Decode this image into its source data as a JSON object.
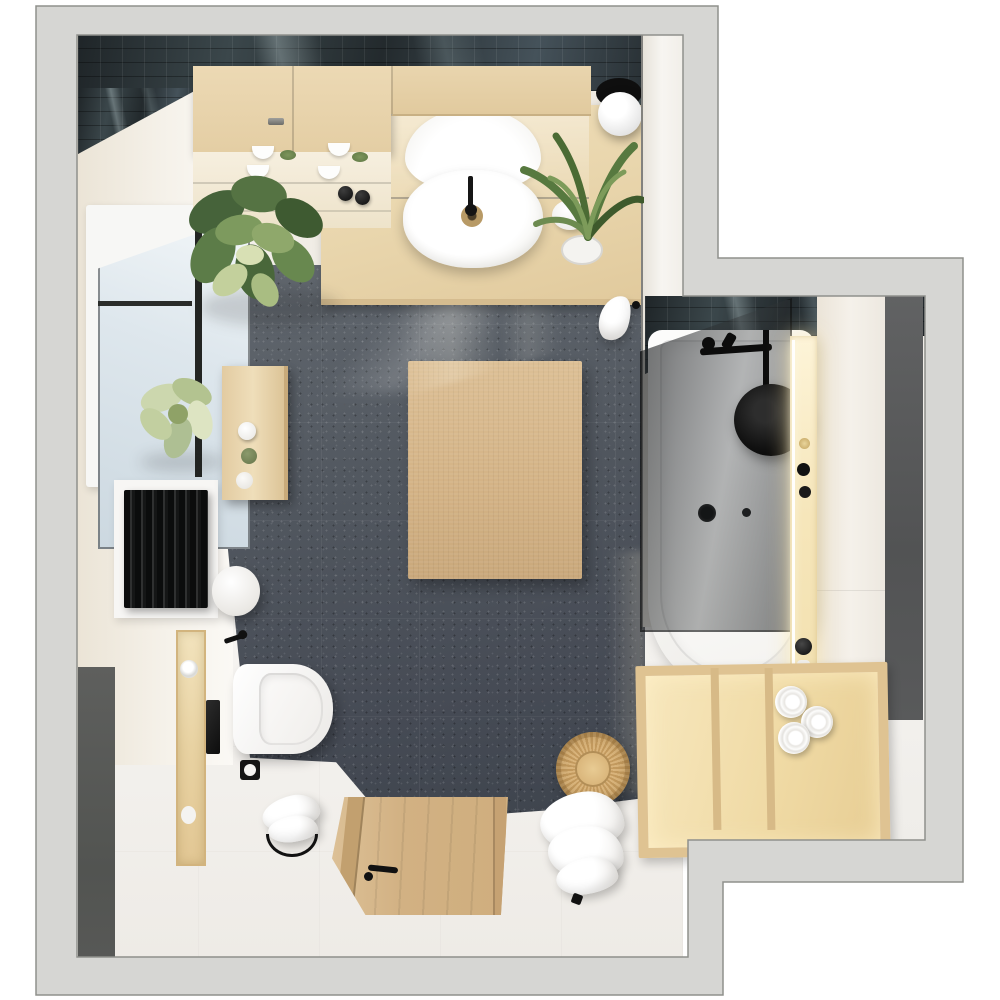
{
  "scene": {
    "type": "photorealistic 3D render, top-down view",
    "subject": "modern bathroom floor plan visualization",
    "rooms": [
      {
        "name": "main-bathroom",
        "floor": "charcoal speckled terrazzo tile with white porcelain border",
        "walls": "white and cream with glossy dark-teal subway tile accent"
      },
      {
        "name": "bathing-alcove",
        "floor": "white porcelain",
        "walls": "cream panels with dark gray accent wall"
      }
    ],
    "fixtures": [
      "wood vanity with white oval countertop basin and black faucet",
      "mirrored cabinet with shelves of white bowls",
      "upper wood cabinets with metal handle",
      "wall-hung white toilet with black flush plate",
      "black toilet paper holder and wall hooks",
      "black flat-panel radiator on white backing",
      "white bathtub with black round rain shower head and black mixer bar",
      "smoked glass shower screen with wood side panel",
      "LED-lit storage niche with black toiletry bottles",
      "wood shelf unit with rolled white towels",
      "casement window with pale blue glass and black sash",
      "wood entry doorway with black door handle",
      "globe ceiling lamp with black mount"
    ],
    "decor": [
      "large fiddle-leaf plant beside vanity",
      "strappy green plant in white pot on counter",
      "pale green flower on windowsill",
      "beige jute rug on dark tile floor",
      "round woven rattan basket",
      "draped white towels on stand",
      "wood bench with candles and cups",
      "white cylindrical stool",
      "wood wall niche with chrome paper rolls"
    ],
    "lighting": "daylight from left window, warm LED glow in niches, glossy reflections on dark tile",
    "palette": {
      "background": "#ffffff",
      "wall_cut": "#d6d6d3",
      "wall_outline": "#8f908c",
      "dark_accent_wall": "#57585a",
      "dark_tile": "#2f383b",
      "charcoal_floor": "#4c525b",
      "wood_light": "#e8d4aa",
      "wood_door": "#d2b183",
      "rug": "#d5b488",
      "niche_glow": "#f6e6ba",
      "fixture_white": "#fbfaf9",
      "plant_green": "#5f8047",
      "basket_tan": "#cfa769"
    }
  }
}
